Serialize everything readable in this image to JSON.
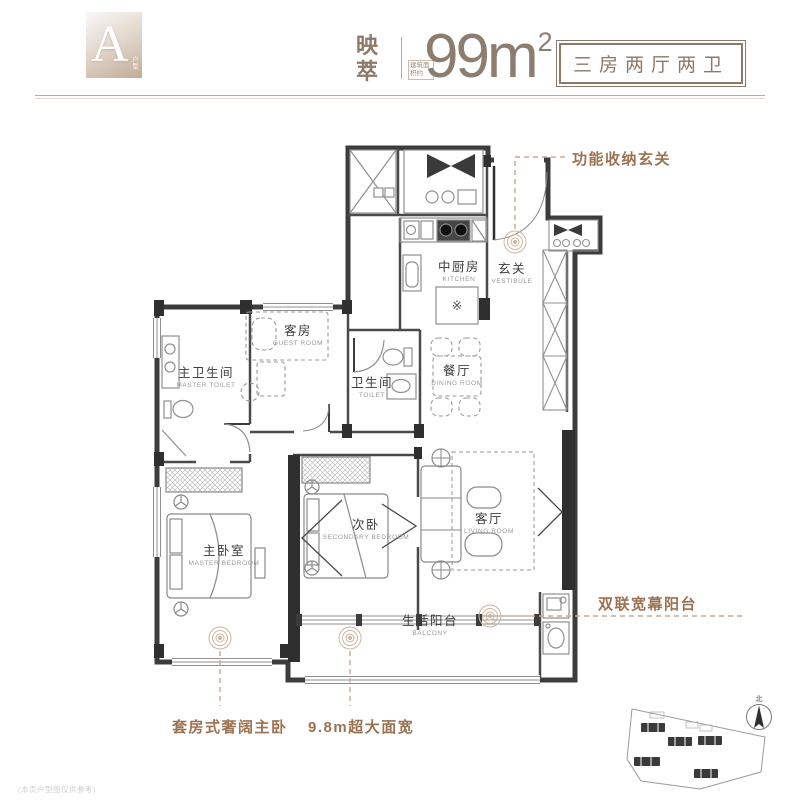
{
  "header": {
    "badge_letter": "A",
    "badge_caption": "户型",
    "series_name": "映萃",
    "area_prefix": "建筑面积约",
    "area_value": "99m",
    "area_exponent": "2",
    "layout_tag": "三房两厅两卫"
  },
  "rooms": [
    {
      "zh": "中厨房",
      "en": "KITCHEN"
    },
    {
      "zh": "玄关",
      "en": "VESTIBULE"
    },
    {
      "zh": "客房",
      "en": "GUEST ROOM"
    },
    {
      "zh": "主卫生间",
      "en": "MASTER TOILET"
    },
    {
      "zh": "卫生间",
      "en": "TOILET"
    },
    {
      "zh": "餐厅",
      "en": "DINING ROOM"
    },
    {
      "zh": "次卧",
      "en": "SECONDARY BEDROOM"
    },
    {
      "zh": "客厅",
      "en": "LIVING ROOM"
    },
    {
      "zh": "主卧室",
      "en": "MASTER BEDROOM"
    },
    {
      "zh": "生活阳台",
      "en": "BALCONY"
    }
  ],
  "annotations": {
    "entry": "功能收纳玄关",
    "balcony": "双联宽幕阳台",
    "master_suite": "套房式奢阔主卧",
    "width": "9.8m超大面宽"
  },
  "symbols": {
    "kitchen_island": "※",
    "compass_north": "北"
  },
  "footnote": "(本页户型图仅供参考)",
  "colors": {
    "accent_brown": "#8d7869",
    "annotation_brown": "#9b7353",
    "wall_dark": "#3c3c3c",
    "leader_tan": "#cfa98a"
  }
}
